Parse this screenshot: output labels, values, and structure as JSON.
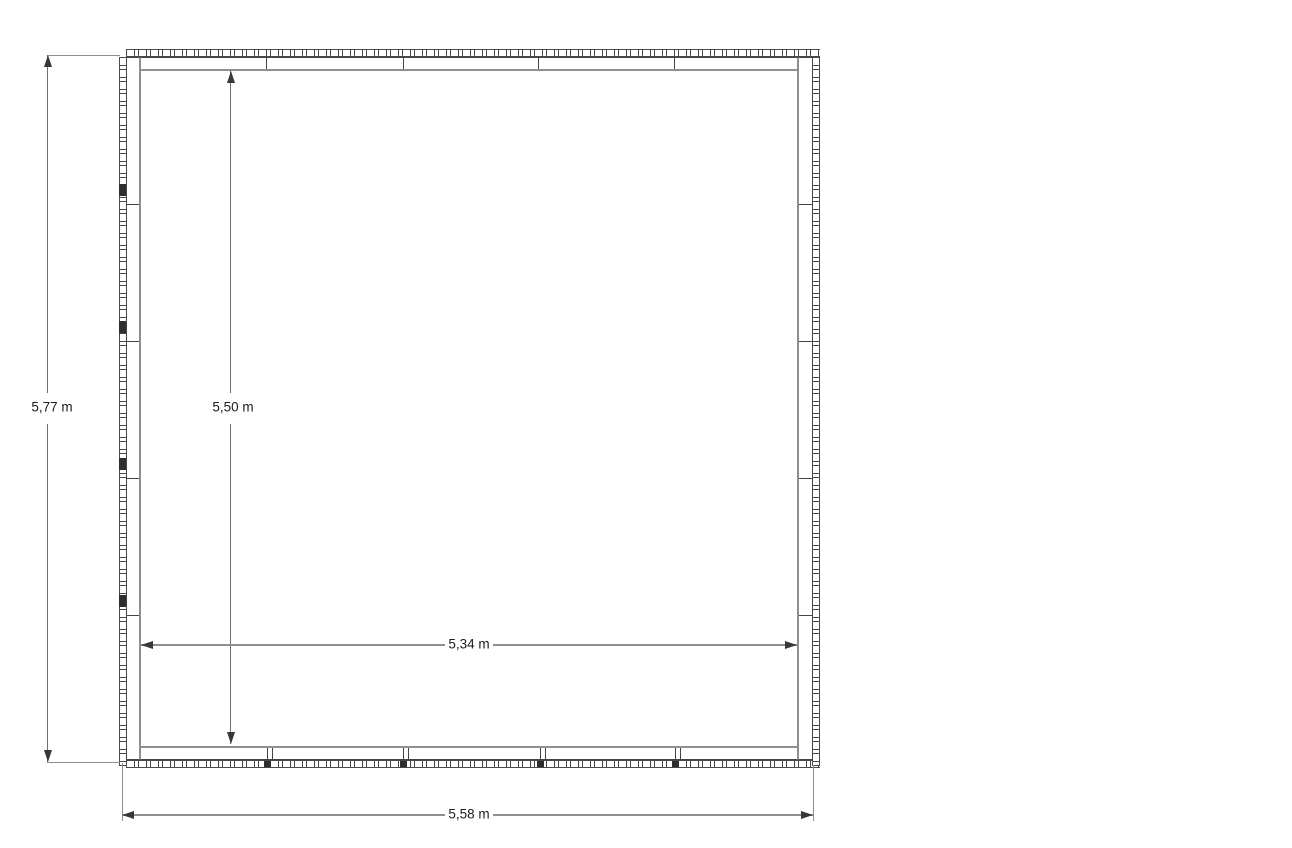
{
  "drawing": {
    "kind": "floor-plan",
    "unit": "m",
    "decimal_separator": ","
  },
  "dimensions": {
    "outer_height": {
      "label": "5,77 m",
      "value": "5,77",
      "unit": "m"
    },
    "inner_height": {
      "label": "5,50 m",
      "value": "5,50",
      "unit": "m"
    },
    "inner_width": {
      "label": "5,34 m",
      "value": "5,34",
      "unit": "m"
    },
    "outer_width": {
      "label": "5,58 m",
      "value": "5,58",
      "unit": "m"
    }
  },
  "colors": {
    "background": "#ffffff",
    "wall_line": "#454545",
    "wall_inner_face": "#8f8f8f",
    "dimension_line": "#8f8f8f",
    "arrow": "#383838",
    "text": "#1c1c1c"
  }
}
